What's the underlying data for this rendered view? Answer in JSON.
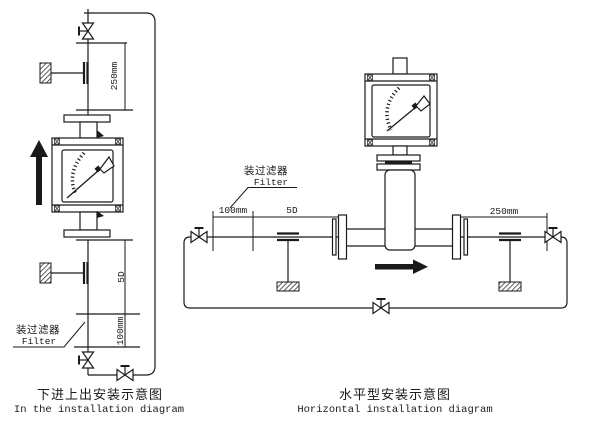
{
  "colors": {
    "line": "#1a1a1a",
    "background": "#ffffff"
  },
  "left_diagram": {
    "caption_zh": "下进上出安装示意图",
    "caption_en": "In the installation diagram",
    "filter_label_zh": "装过滤器",
    "filter_label_en": "Filter",
    "dim_top": "250mm",
    "dim_middle": "5D",
    "dim_bottom": "100mm"
  },
  "right_diagram": {
    "caption_zh": "水平型安装示意图",
    "caption_en": "Horizontal installation diagram",
    "filter_label_zh": "装过滤器",
    "filter_label_en": "Filter",
    "dim_left": "100mm",
    "dim_mid": "5D",
    "dim_right": "250mm"
  }
}
